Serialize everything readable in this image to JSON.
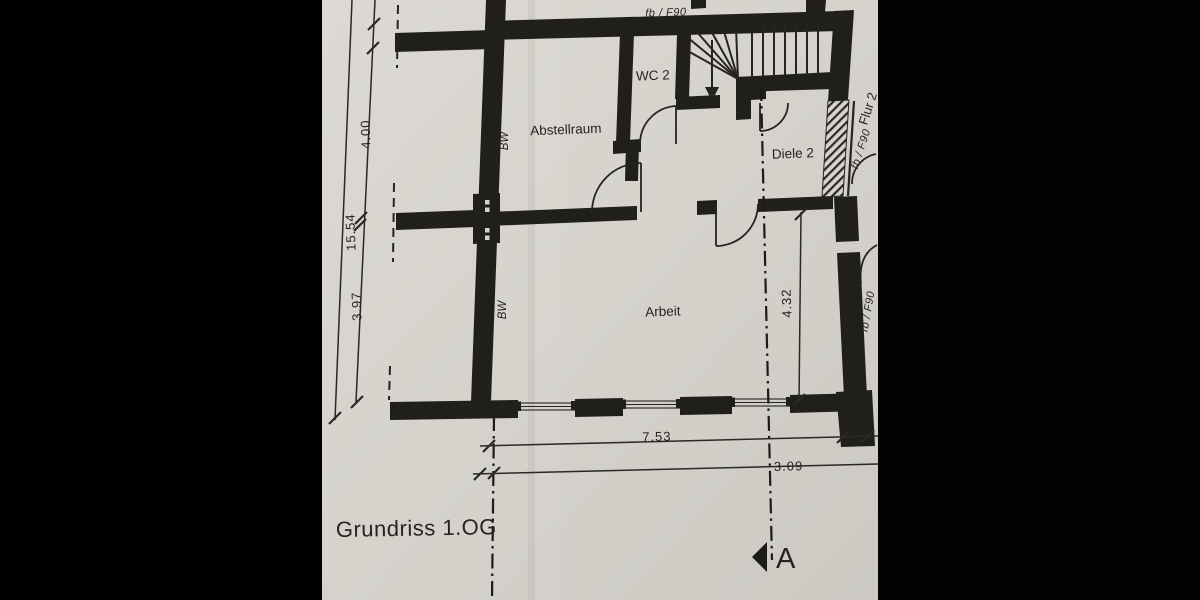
{
  "plan": {
    "title": "Grundriss 1.OG",
    "rooms": {
      "abstellraum": "Abstellraum",
      "wc": "WC 2",
      "diele": "Diele 2",
      "arbeit": "Arbeit",
      "flur": "Flur 2"
    },
    "dimensions": {
      "total_left": "15.54",
      "upper_left": "4.00",
      "lower_left": "3.97",
      "arbeit_depth": "4.32",
      "bottom_main": "7.53",
      "bottom_right": "3.09"
    },
    "wall_labels": {
      "bearing_wall": "BW",
      "fire_rating": "fb / F90"
    },
    "section_marker": "A",
    "colors": {
      "paper": "#d7d4ce",
      "ink": "#26241f",
      "letterbox": "#000000"
    }
  }
}
